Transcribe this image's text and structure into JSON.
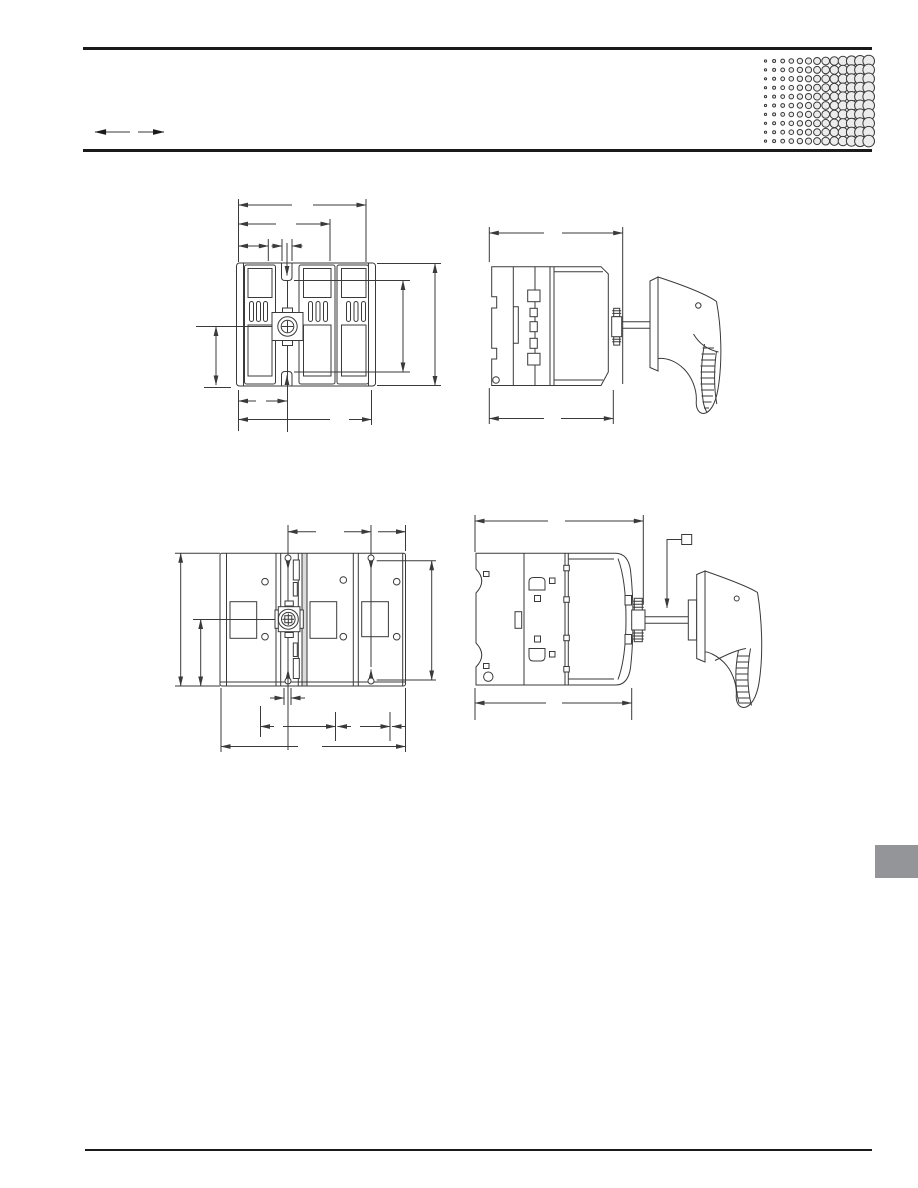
{
  "page": {
    "width": 918,
    "height": 1188,
    "background": "#ffffff"
  },
  "header": {
    "top_rule_color": "#1a1a1a",
    "bottom_rule_color": "#1a1a1a",
    "nav_arrows": [
      {
        "icon": "arrow-left-icon"
      },
      {
        "icon": "arrow-right-icon"
      }
    ]
  },
  "decor": {
    "halftone": {
      "cols": 13,
      "rows": 10,
      "x0": 765.5,
      "y0": 61,
      "dx": 8.6,
      "dy": 8.9,
      "r_base": 1.1,
      "r_step": 0.4,
      "r_max": 5.8,
      "color": "#ececec"
    },
    "side_tab_color": "#939598"
  },
  "drawing": {
    "ink_color": "#3a3a3a",
    "figures": [
      {
        "id": "front-view",
        "name": "switch-front-view-dimension-drawing"
      },
      {
        "id": "side-view",
        "name": "switch-side-view-with-handle-dimension-drawing"
      },
      {
        "id": "back-view",
        "name": "switch-back-view-dimension-drawing"
      },
      {
        "id": "side-view-2",
        "name": "switch-side-view-with-handle-and-callout-drawing"
      }
    ]
  },
  "footer": {
    "rule_color": "#1a1a1a"
  }
}
